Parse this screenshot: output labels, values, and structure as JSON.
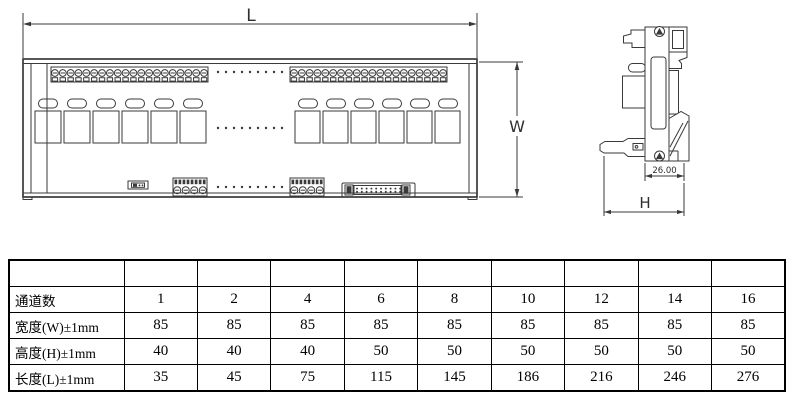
{
  "colors": {
    "drawing_line": "#3a3a3a",
    "table_border": "#000000",
    "background": "#ffffff"
  },
  "drawings": {
    "front_view": {
      "length_dim_label": "L",
      "width_dim_label": "W",
      "channel_groups": {
        "left_count": 6,
        "right_count": 6
      },
      "terminal_strip": {
        "left_pins": 20,
        "right_pins": 20
      },
      "bottom_terminal_pins": 4,
      "idc_pins_per_row": 10,
      "ellipsis_dots": 9
    },
    "side_view": {
      "depth_dim_value": "26.00",
      "height_dim_label": "H"
    }
  },
  "table": {
    "rows": [
      {
        "label": "通道数",
        "values": [
          "1",
          "2",
          "4",
          "6",
          "8",
          "10",
          "12",
          "14",
          "16"
        ]
      },
      {
        "label": "宽度(W)±1mm",
        "values": [
          "85",
          "85",
          "85",
          "85",
          "85",
          "85",
          "85",
          "85",
          "85"
        ]
      },
      {
        "label": "高度(H)±1mm",
        "values": [
          "40",
          "40",
          "40",
          "50",
          "50",
          "50",
          "50",
          "50",
          "50"
        ]
      },
      {
        "label": "长度(L)±1mm",
        "values": [
          "35",
          "45",
          "75",
          "115",
          "145",
          "186",
          "216",
          "246",
          "276"
        ]
      }
    ]
  }
}
